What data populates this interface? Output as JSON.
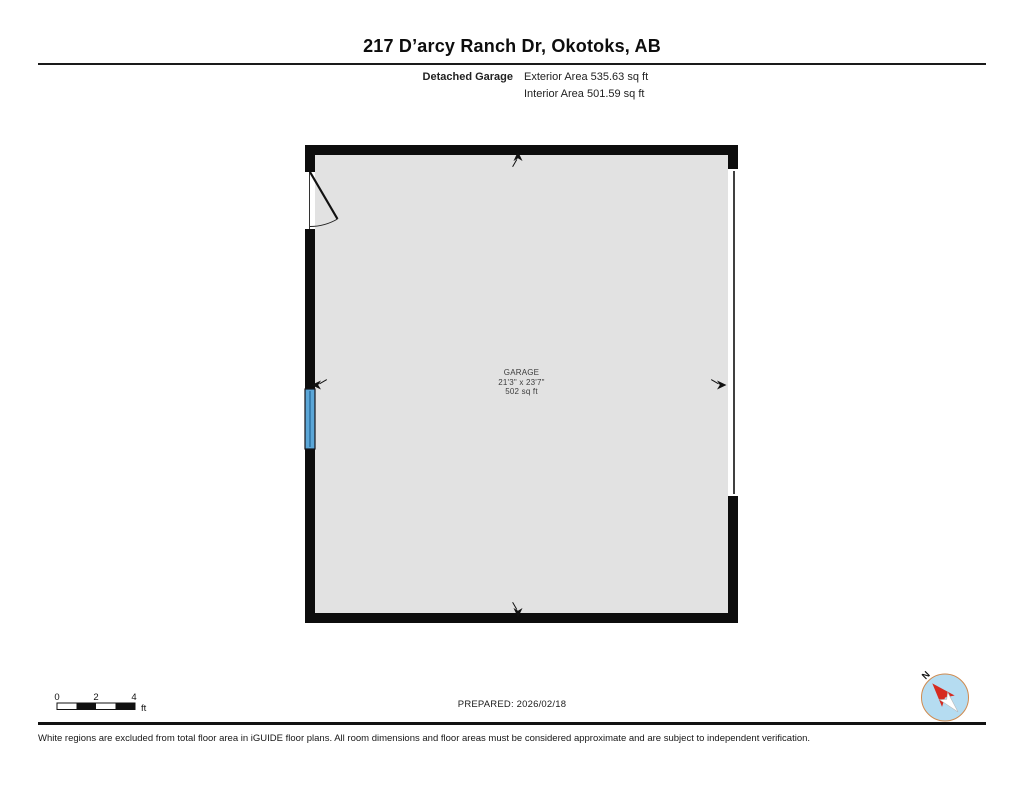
{
  "header": {
    "title": "217 D’arcy Ranch Dr, Okotoks, AB"
  },
  "unit_summary": {
    "label": "Detached Garage",
    "exterior_area": "Exterior Area 535.63 sq ft",
    "interior_area": "Interior Area 501.59 sq ft"
  },
  "plan": {
    "room_name": "GARAGE",
    "room_dimensions": "21'3\" x 23'7\"",
    "room_area": "502 sq ft",
    "features": [
      "hinged-entry-door-top-left",
      "window-left-wall",
      "garage-door-right-wall"
    ],
    "colors": {
      "floor": "#e2e2e2",
      "wall": "#0d0d0d",
      "window_blue": "#5ba6d7"
    }
  },
  "footer": {
    "scale_ticks": [
      "0",
      "2",
      "4"
    ],
    "scale_unit": "ft",
    "prepared": "PREPARED: 2026/02/18",
    "compass_label": "N",
    "compass_colors": {
      "circle_fill": "#b5dcf1",
      "ring": "#cf8a4e",
      "needle_red": "#d62b20"
    },
    "disclaimer": "White regions are excluded from total floor area in iGUIDE floor plans. All room dimensions and floor areas must be considered approximate and are subject to independent verification."
  }
}
